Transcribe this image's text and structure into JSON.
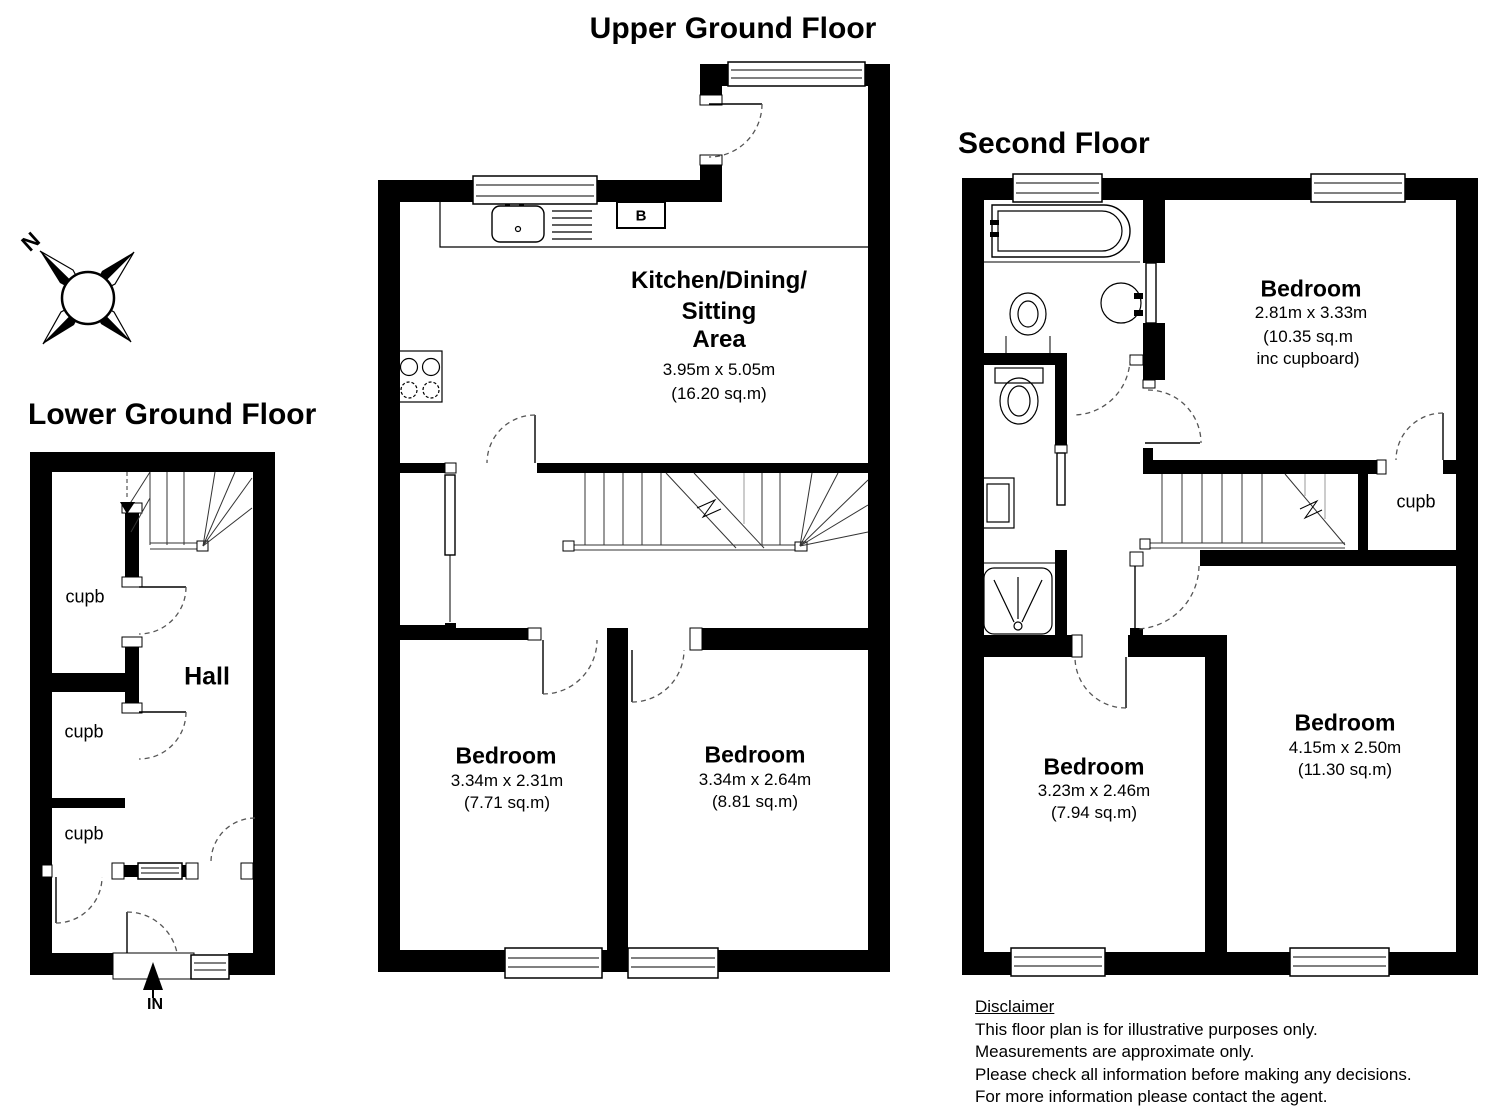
{
  "page": {
    "background": "#ffffff",
    "line_color": "#000000"
  },
  "compass": {
    "north_label": "N"
  },
  "floors": {
    "lower_ground": {
      "title": "Lower Ground Floor",
      "hall_label": "Hall",
      "cupboards": [
        "cupb",
        "cupb",
        "cupb"
      ],
      "entrance_label": "IN"
    },
    "upper_ground": {
      "title": "Upper Ground Floor",
      "boiler_label": "B",
      "kitchen": {
        "name_lines": [
          "Kitchen/Dining/",
          "Sitting",
          "Area"
        ],
        "dims": "3.95m x 5.05m",
        "area": "(16.20 sq.m)"
      },
      "bedroom_left": {
        "name": "Bedroom",
        "dims": "3.34m x 2.31m",
        "area": "(7.71 sq.m)"
      },
      "bedroom_right": {
        "name": "Bedroom",
        "dims": "3.34m x 2.64m",
        "area": "(8.81 sq.m)"
      }
    },
    "second": {
      "title": "Second Floor",
      "cupboard_label": "cupb",
      "bedroom_top": {
        "name": "Bedroom",
        "dims": "2.81m x 3.33m",
        "area_lines": [
          "(10.35 sq.m",
          "inc cupboard)"
        ]
      },
      "bedroom_bottom_left": {
        "name": "Bedroom",
        "dims": "3.23m x 2.46m",
        "area": "(7.94 sq.m)"
      },
      "bedroom_bottom_right": {
        "name": "Bedroom",
        "dims": "4.15m x 2.50m",
        "area": "(11.30 sq.m)"
      }
    }
  },
  "disclaimer": {
    "heading": "Disclaimer",
    "lines": [
      "This floor plan is for illustrative purposes only.",
      "Measurements are approximate only.",
      "Please check all information before making any decisions.",
      "For more information please contact the agent."
    ]
  }
}
